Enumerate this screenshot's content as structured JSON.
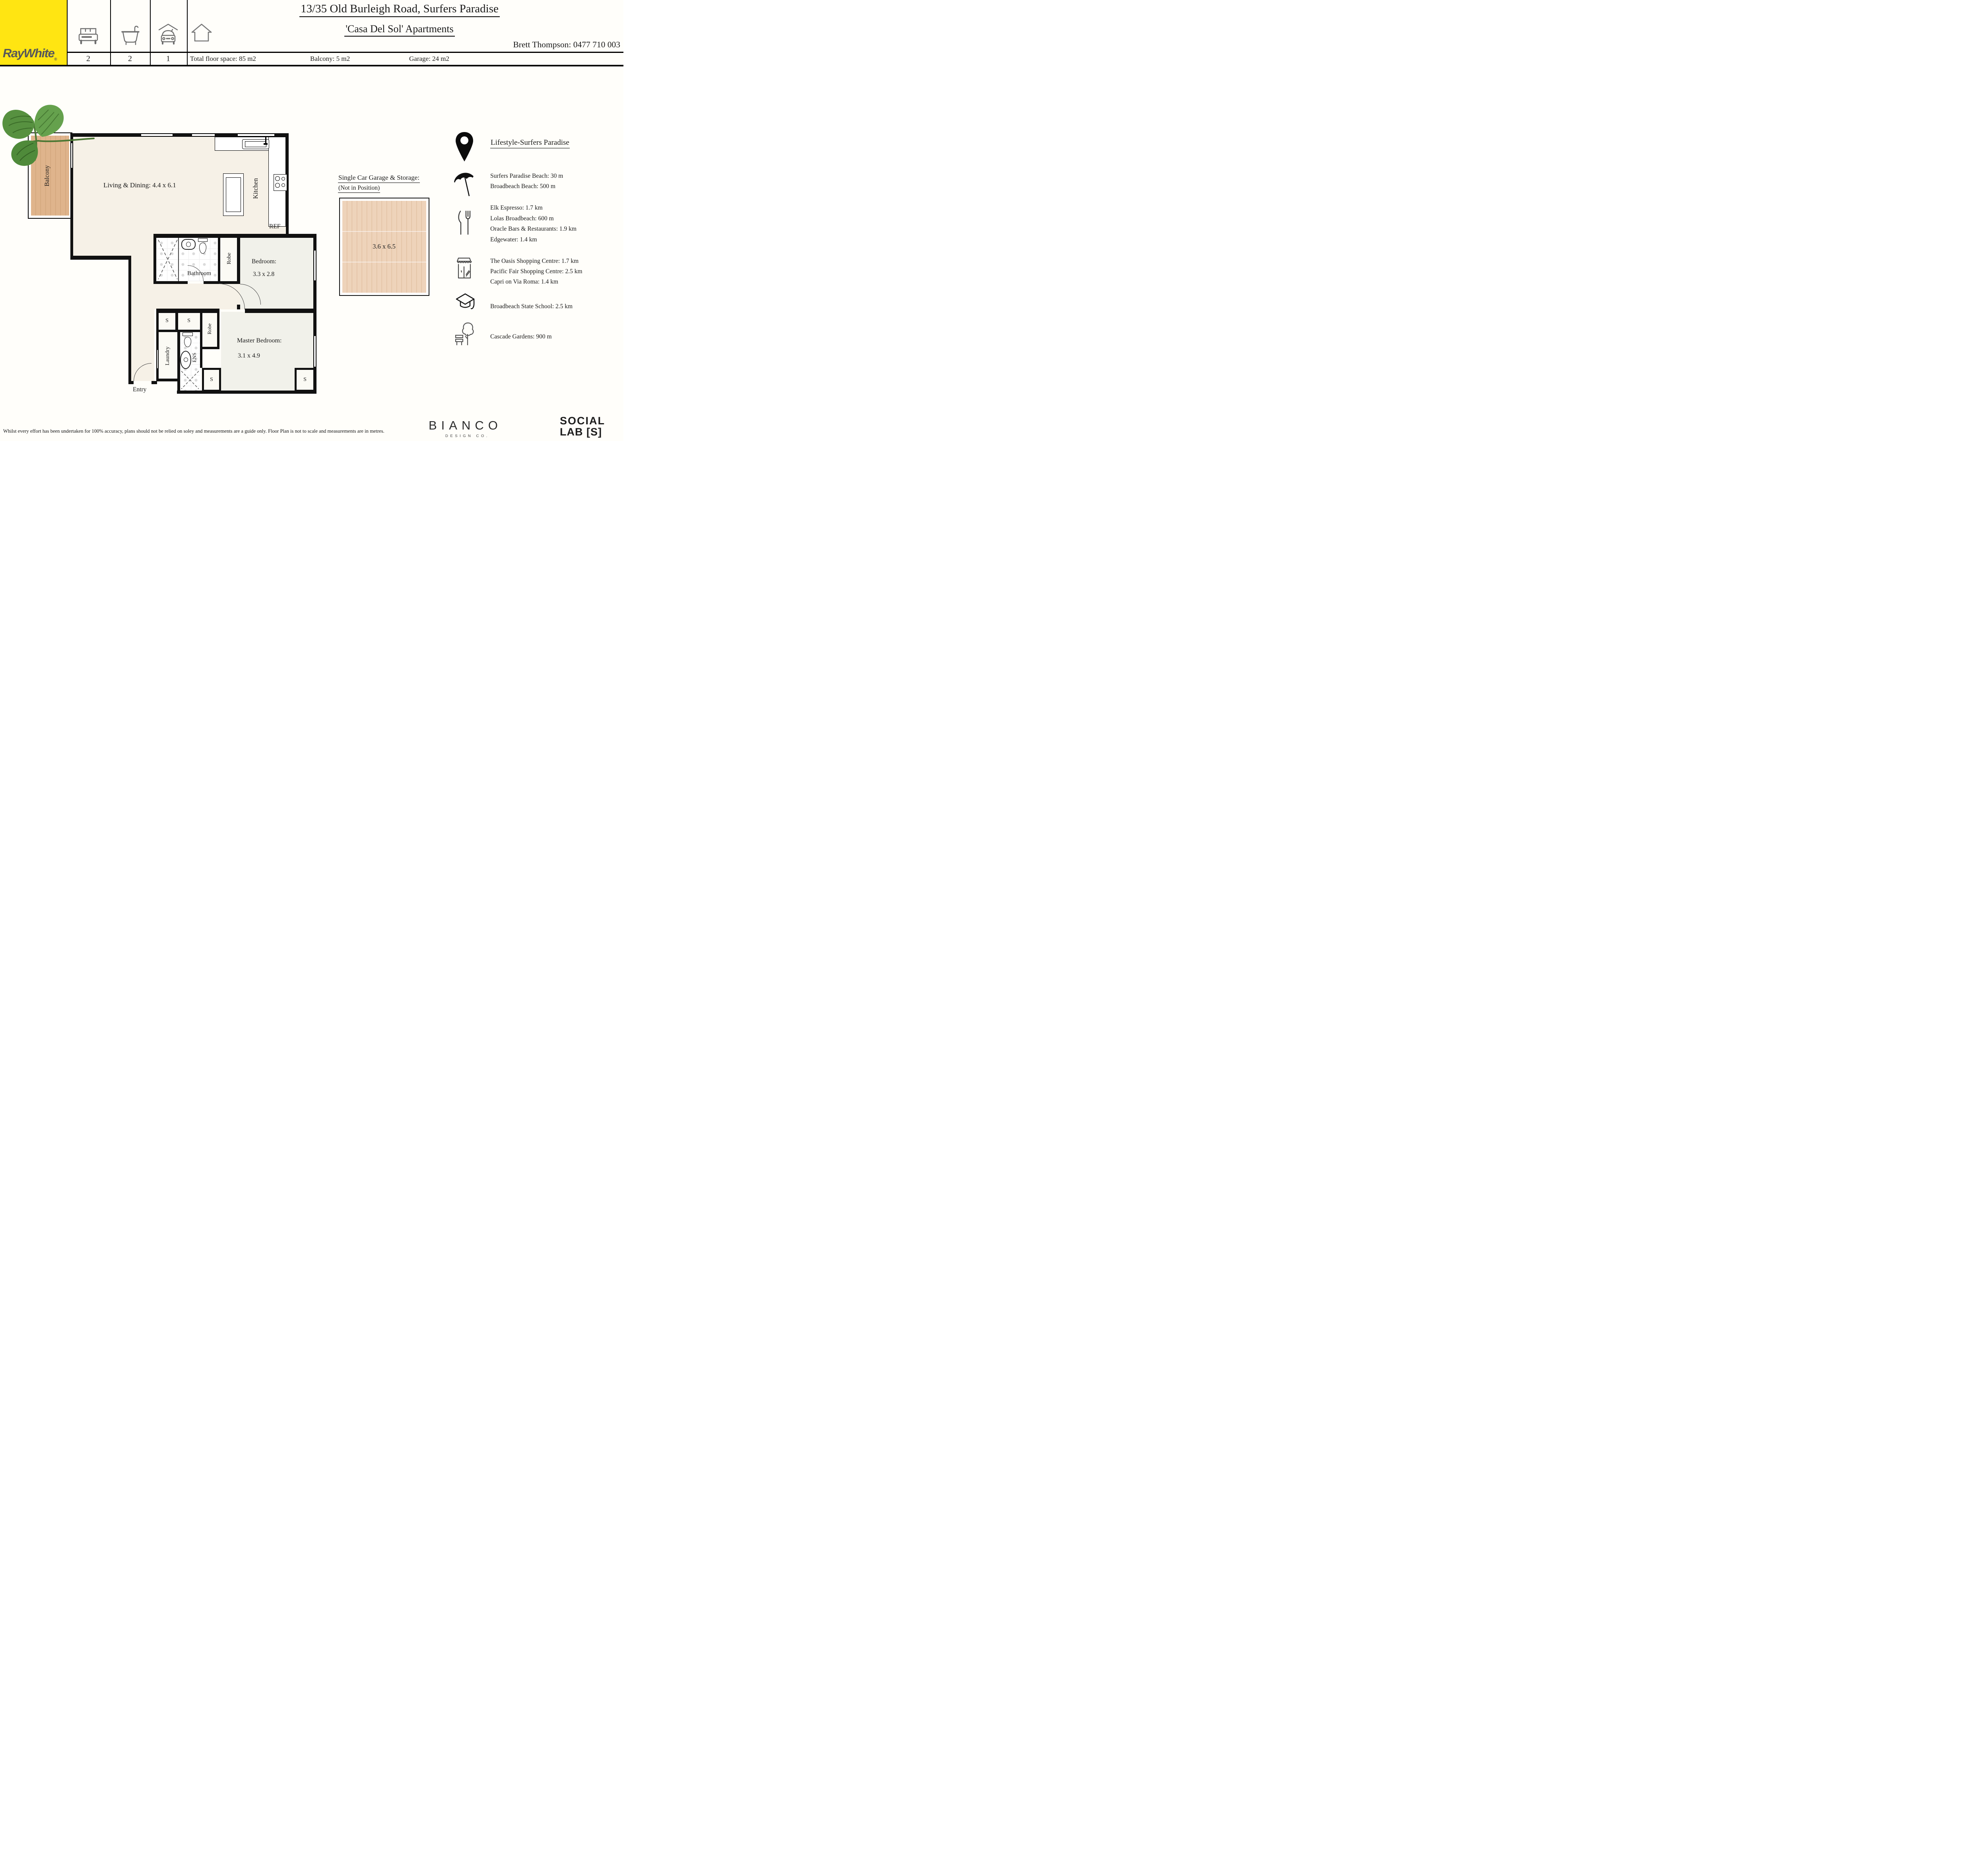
{
  "header": {
    "brand": "RayWhite",
    "brand_mark": "®",
    "title": "13/35 Old Burleigh Road, Surfers Paradise",
    "subtitle": "'Casa Del Sol' Apartments",
    "agent": "Brett Thompson: 0477 710 003",
    "beds": "2",
    "baths": "2",
    "cars": "1",
    "total_floor_space": "Total floor space: 85 m2",
    "balcony_area": "Balcony: 5 m2",
    "garage_area": "Garage: 24 m2"
  },
  "floorplan": {
    "living": "Living & Dining: 4.4 x 6.1",
    "kitchen": "Kitchen",
    "ref": "REF",
    "balcony": "Balcony",
    "bathroom": "Bathroom",
    "robe": "Robe",
    "bedroom": "Bedroom:",
    "bedroom_dims": "3.3 x 2.8",
    "laundry": "Laundry",
    "ens": "ENS",
    "master": "Master Bedroom:",
    "master_dims": "3.1 x 4.9",
    "entry": "Entry",
    "storage": "S"
  },
  "garage": {
    "title": "Single Car Garage & Storage:",
    "subtitle": "(Not in Position)",
    "dims": "3.6 x 6.5"
  },
  "lifestyle": {
    "heading": "Lifestyle-Surfers Paradise",
    "beaches": [
      "Surfers Paradise Beach: 30 m",
      "Broadbeach Beach: 500 m"
    ],
    "dining": [
      "Elk Espresso: 1.7 km",
      "Lolas Broadbeach: 600 m",
      "Oracle Bars & Restaurants: 1.9 km",
      "Edgewater: 1.4 km"
    ],
    "shopping": [
      "The Oasis Shopping Centre: 1.7 km",
      "Pacific Fair Shopping Centre: 2.5 km",
      "Capri on Via Roma: 1.4 km"
    ],
    "school": "Broadbeach State School: 2.5 km",
    "park": "Cascade Gardens: 900 m"
  },
  "footer": {
    "disclaimer": "Whilst every effort has been undertaken for 100% accuracy, plans should not be relied on soley and measurements are a guide only. Floor Plan is not to scale and measurements are in metres.",
    "bianco": "BIANCO",
    "bianco_sub": "DESIGN CO.",
    "social_1": "SOCIAL",
    "social_2": "LAB [S]"
  },
  "colors": {
    "brand_yellow": "#FFE512",
    "wall": "#111111",
    "floor_beige": "#F6F1E7",
    "room_grey": "#F1F1EA",
    "balcony_wood": "#DFB48C",
    "garage_wood": "#EED3BA",
    "leaf_green": "#55923F"
  }
}
